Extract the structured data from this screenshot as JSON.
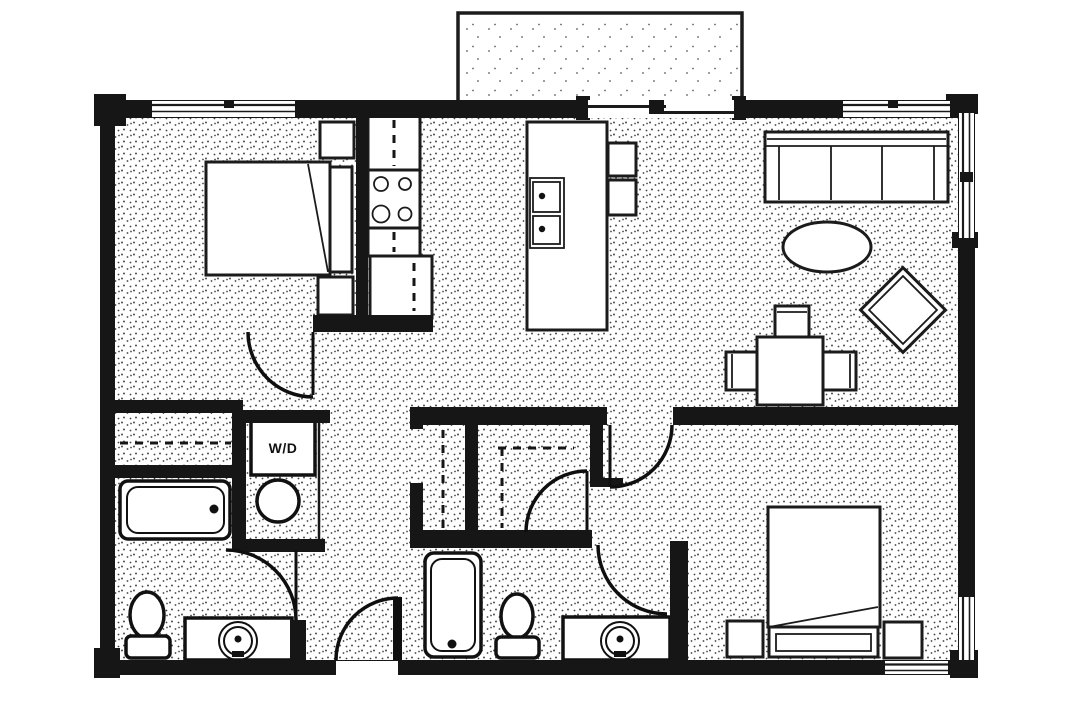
{
  "plan": {
    "labels": {
      "washer_dryer": "W/D"
    },
    "colors": {
      "wall": "#161616",
      "line": "#1b1b1b",
      "paper": "#ffffff",
      "floor_stipple": "#404040"
    }
  }
}
